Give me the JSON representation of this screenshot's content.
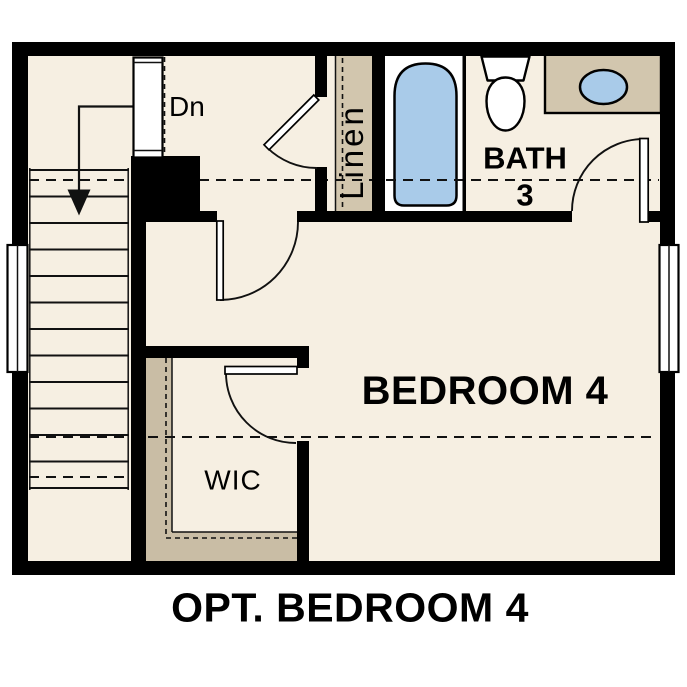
{
  "title": "OPT. BEDROOM 4",
  "rooms": {
    "bedroom": "BEDROOM 4",
    "bath": "BATH",
    "bath_number": "3",
    "closet": "WIC",
    "linen": "Linen"
  },
  "annotations": {
    "stair_direction": "Dn"
  },
  "colors": {
    "background": "#ffffff",
    "floor": "#f6efe2",
    "wall": "#000000",
    "cabinet_tan": "#d2c6ae",
    "closet_tan": "#c9bda5",
    "fixture_blue": "#a9cbe9",
    "line": "#111111",
    "text": "#000000"
  }
}
